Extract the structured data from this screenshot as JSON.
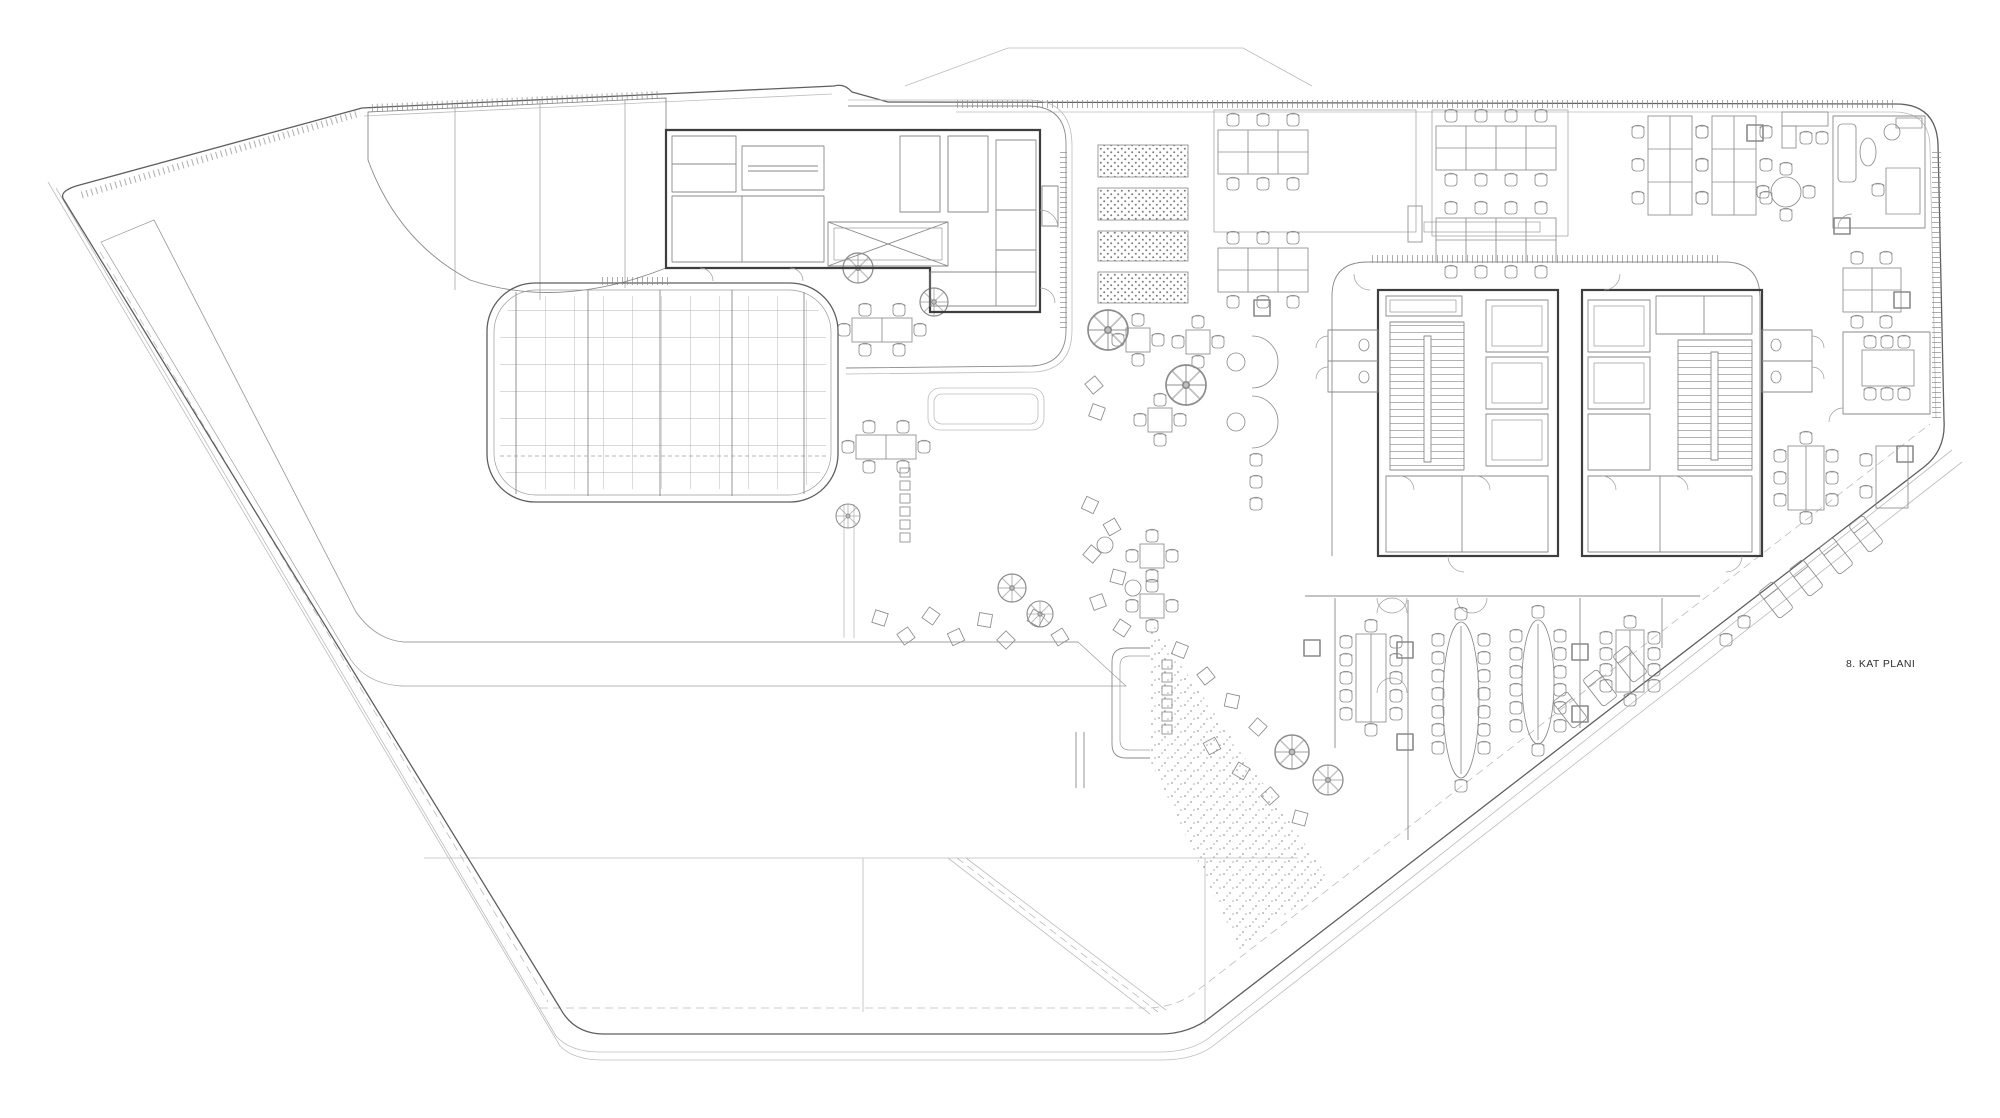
{
  "drawing": {
    "floor_label": "8. KAT PLANI"
  },
  "palette": {
    "background": "#ffffff",
    "outline": "#5f5f5f",
    "line_medium": "#8a8a8a",
    "line_light": "#bcbcbc",
    "wall": "#3e3e3e",
    "stipple_dot": "#8f8f8f",
    "label_text": "#2f2f2f"
  },
  "legend": {
    "areas": [
      {
        "name": "roof-terrace-garden",
        "features": [
          "planted-stipple-band",
          "lounge-scatter-seats",
          "trees",
          "cafe-tables"
        ]
      },
      {
        "name": "skylight-grid-roof",
        "grid_cols": 12,
        "grid_rows": 8
      },
      {
        "name": "louver-roof"
      },
      {
        "name": "service-core-small",
        "features": [
          "stairs",
          "elevator-x",
          "rooms"
        ]
      },
      {
        "name": "open-office",
        "features": [
          "desk-clusters",
          "glass-partitions",
          "private-office",
          "meeting-room"
        ]
      },
      {
        "name": "central-core",
        "towers": 2,
        "features": [
          "stairs",
          "elevators",
          "wc"
        ]
      },
      {
        "name": "canteen-long-tables",
        "table_count": 4
      },
      {
        "name": "planter-panels",
        "count": 4
      }
    ]
  }
}
